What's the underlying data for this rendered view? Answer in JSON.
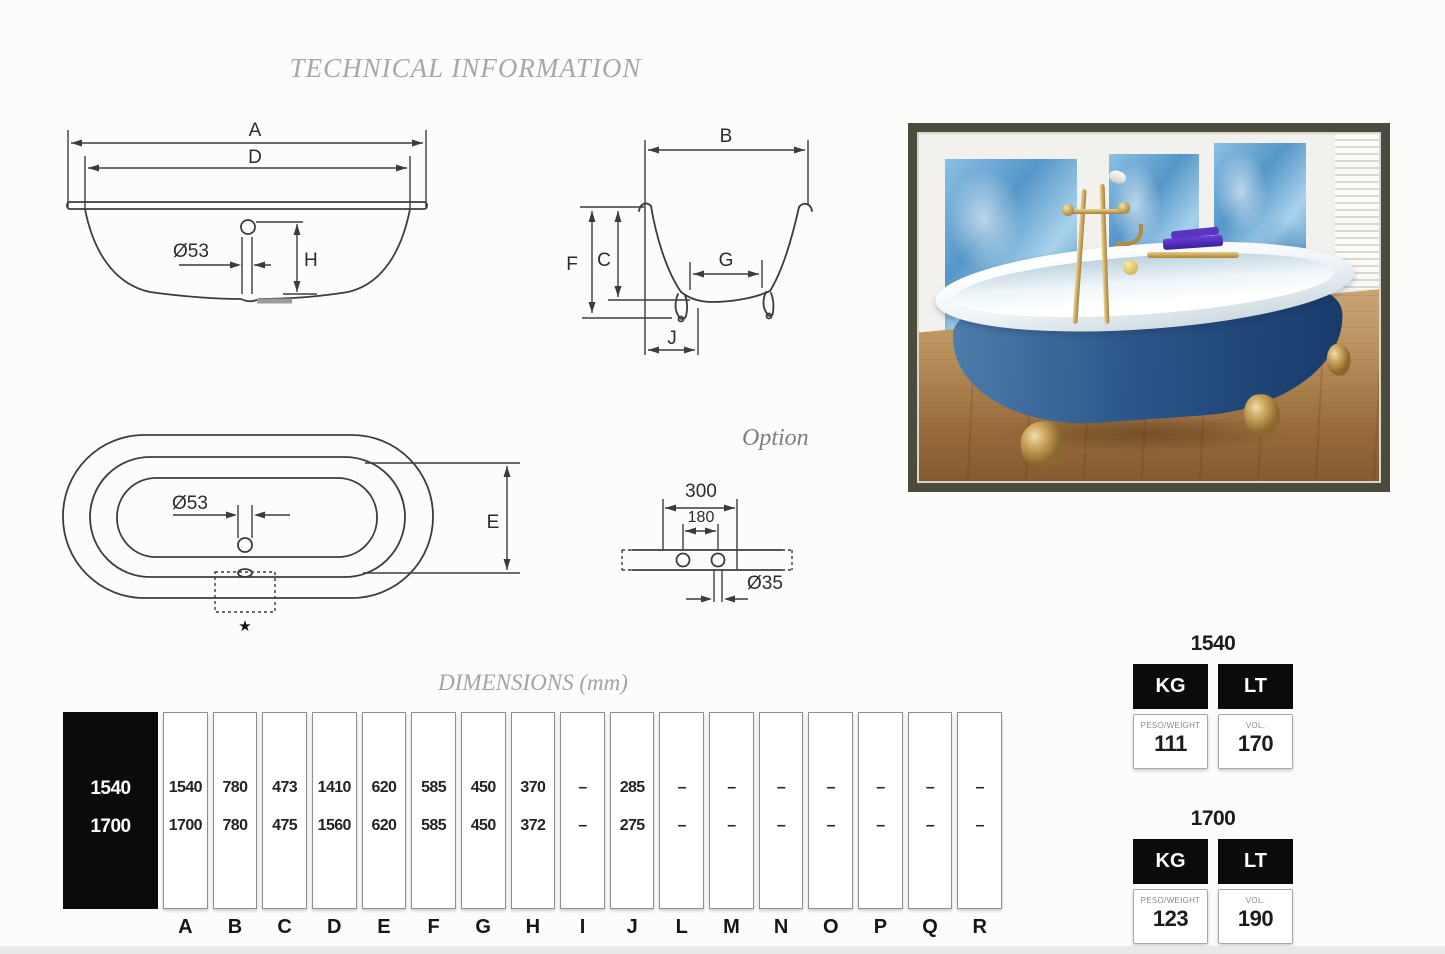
{
  "page": {
    "title": "TECHNICAL INFORMATION"
  },
  "drawings": {
    "side_view": {
      "labels": {
        "length": "A",
        "inner_length": "D",
        "drain_diameter": "Ø53",
        "drain_height": "H"
      }
    },
    "end_view": {
      "labels": {
        "width": "B",
        "total_height": "F",
        "depth": "C",
        "base_width": "G",
        "foot_inset": "J"
      }
    },
    "top_view": {
      "labels": {
        "drain_diameter": "Ø53",
        "inner_width": "E",
        "note_marker": "★"
      }
    },
    "option_view": {
      "title": "Option",
      "labels": {
        "outer_span": "300",
        "inner_span": "180",
        "hole_diameter": "Ø35"
      }
    }
  },
  "dimensions": {
    "title": "DIMENSIONS (mm)",
    "columns": [
      "A",
      "B",
      "C",
      "D",
      "E",
      "F",
      "G",
      "H",
      "I",
      "J",
      "L",
      "M",
      "N",
      "O",
      "P",
      "Q",
      "R"
    ],
    "rows": [
      {
        "model": "1540",
        "values": [
          "1540",
          "780",
          "473",
          "1410",
          "620",
          "585",
          "450",
          "370",
          "–",
          "285",
          "–",
          "–",
          "–",
          "–",
          "–",
          "–",
          "–"
        ]
      },
      {
        "model": "1700",
        "values": [
          "1700",
          "780",
          "475",
          "1560",
          "620",
          "585",
          "450",
          "372",
          "–",
          "275",
          "–",
          "–",
          "–",
          "–",
          "–",
          "–",
          "–"
        ]
      }
    ]
  },
  "spec_cards": [
    {
      "model": "1540",
      "weight_unit": "KG",
      "volume_unit": "LT",
      "weight_caption": "PESO/WEIGHT",
      "weight_value": "111",
      "volume_caption": "VOL.",
      "volume_value": "170"
    },
    {
      "model": "1700",
      "weight_unit": "KG",
      "volume_unit": "LT",
      "weight_caption": "PESO/WEIGHT",
      "weight_value": "123",
      "volume_caption": "VOL.",
      "volume_value": "190"
    }
  ],
  "colors": {
    "drawing_line": "#3c3c3e",
    "heading_text": "#a7a7ab",
    "table_black": "#0b0b0b",
    "photo_frame": "#4c4c3e",
    "tub_blue": "#2a5488",
    "brass_gold": "#caa45c",
    "panel_blue": "#5596c8"
  }
}
